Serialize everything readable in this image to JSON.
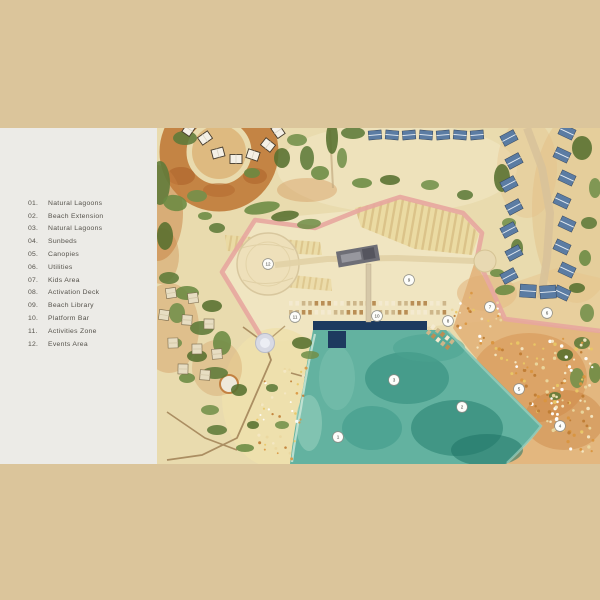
{
  "page": {
    "background_color": "#dbc59b"
  },
  "legend": {
    "panel_color": "#ecebe7",
    "text_color": "#55524b",
    "items": [
      {
        "num": "01.",
        "label": "Natural Lagoons"
      },
      {
        "num": "02.",
        "label": "Beach Extension"
      },
      {
        "num": "03.",
        "label": "Natural Lagoons"
      },
      {
        "num": "04.",
        "label": "Sunbeds"
      },
      {
        "num": "05.",
        "label": "Canopies"
      },
      {
        "num": "06.",
        "label": "Utilities"
      },
      {
        "num": "07.",
        "label": "Kids Area"
      },
      {
        "num": "08.",
        "label": "Activation Deck"
      },
      {
        "num": "09.",
        "label": "Beach Library"
      },
      {
        "num": "10.",
        "label": "Platform Bar"
      },
      {
        "num": "11.",
        "label": "Activities Zone"
      },
      {
        "num": "12.",
        "label": "Events Area"
      }
    ]
  },
  "map": {
    "colors": {
      "sand": "#e9dbae",
      "sand_light": "#f1e7c6",
      "beach_orange": "#e2b077",
      "terracotta": "#c07a39",
      "water": "#63b2a0",
      "water_dark": "#2f8b7a",
      "pool_navy": "#1d3a5f",
      "boundary_pink": "#e7a69f",
      "vegetation": "#5d7a39",
      "roof_blue": "#5b7ca3",
      "tent_white": "#f4f0e6",
      "path_brown": "#ab8e62",
      "road_light": "#e2d2a6"
    },
    "markers": [
      {
        "n": "1",
        "x": 181,
        "y": 309
      },
      {
        "n": "2",
        "x": 305,
        "y": 279
      },
      {
        "n": "3",
        "x": 237,
        "y": 252
      },
      {
        "n": "4",
        "x": 403,
        "y": 298
      },
      {
        "n": "5",
        "x": 362,
        "y": 261
      },
      {
        "n": "6",
        "x": 390,
        "y": 185
      },
      {
        "n": "7",
        "x": 333,
        "y": 179
      },
      {
        "n": "8",
        "x": 291,
        "y": 193
      },
      {
        "n": "9",
        "x": 252,
        "y": 152
      },
      {
        "n": "10",
        "x": 220,
        "y": 188
      },
      {
        "n": "11",
        "x": 138,
        "y": 189
      },
      {
        "n": "12",
        "x": 111,
        "y": 136
      }
    ]
  }
}
